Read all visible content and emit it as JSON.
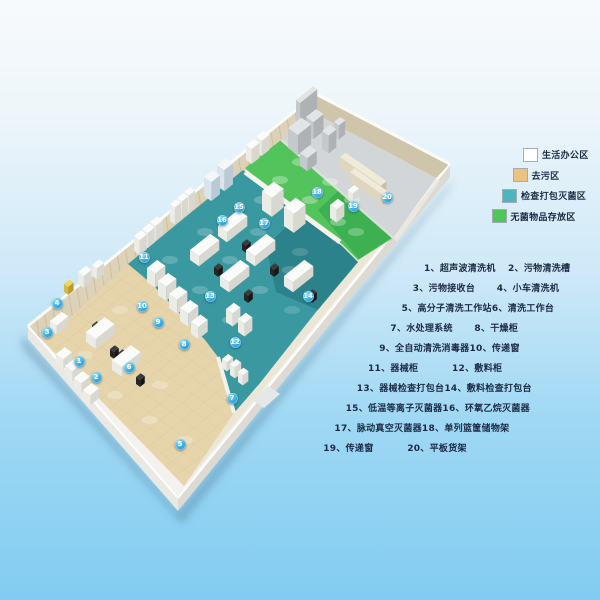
{
  "legend": {
    "items": [
      {
        "id": "office",
        "label": "生活办公区",
        "color": "#ffffff"
      },
      {
        "id": "decontamination",
        "label": "去污区",
        "color": "#e9c37f"
      },
      {
        "id": "inspect-pack-sterilize",
        "label": "检查打包灭菌区",
        "color": "#4db4c0"
      },
      {
        "id": "sterile-storage",
        "label": "无菌物品存放区",
        "color": "#4ec65c"
      }
    ]
  },
  "equipment_list": {
    "rows": [
      {
        "c1": "1、超声波清洗机",
        "c2": "2、污物清洗槽"
      },
      {
        "c1": "3、污物接收台",
        "c2": "4、小车清洗机"
      },
      {
        "c1": "5、高分子清洗工作站",
        "c2": "6、清洗工作台"
      },
      {
        "c1": "7、水处理系统",
        "c2": "8、干燥柜"
      },
      {
        "c1": "9、全自动清洗消毒器",
        "c2": "10、传递窗"
      },
      {
        "c1": "11、器械柜",
        "c2": "12、敷料柜"
      },
      {
        "c1": "13、器械检查打包台",
        "c2": "14、敷料检查打包台"
      },
      {
        "c1": "15、低温等离子灭菌器",
        "c2": "16、环氧乙烷灭菌器"
      },
      {
        "c1": "17、脉动真空灭菌器",
        "c2": "18、单列篮筐储物架"
      },
      {
        "c1": "19、传递窗",
        "c2": "20、平板货架"
      }
    ]
  },
  "floor_markers": [
    {
      "n": "1",
      "x": 79,
      "y": 361
    },
    {
      "n": "2",
      "x": 96,
      "y": 377
    },
    {
      "n": "3",
      "x": 47,
      "y": 332
    },
    {
      "n": "4",
      "x": 57,
      "y": 303
    },
    {
      "n": "5",
      "x": 180,
      "y": 444
    },
    {
      "n": "6",
      "x": 129,
      "y": 367
    },
    {
      "n": "7",
      "x": 232,
      "y": 398
    },
    {
      "n": "8",
      "x": 184,
      "y": 344
    },
    {
      "n": "9",
      "x": 158,
      "y": 322
    },
    {
      "n": "10",
      "x": 142,
      "y": 306
    },
    {
      "n": "11",
      "x": 144,
      "y": 257
    },
    {
      "n": "12",
      "x": 235,
      "y": 342
    },
    {
      "n": "13",
      "x": 210,
      "y": 296
    },
    {
      "n": "14",
      "x": 308,
      "y": 296
    },
    {
      "n": "15",
      "x": 239,
      "y": 207
    },
    {
      "n": "16",
      "x": 222,
      "y": 220
    },
    {
      "n": "17",
      "x": 264,
      "y": 223
    },
    {
      "n": "18",
      "x": 317,
      "y": 192
    },
    {
      "n": "19",
      "x": 353,
      "y": 206
    },
    {
      "n": "20",
      "x": 387,
      "y": 197
    }
  ],
  "palette": {
    "background_top": "#f7fafc",
    "background_bottom": "#82ccf1",
    "floor_decontamination": "#e6d5ab",
    "floor_sterilization": "#3a98a1",
    "floor_sterile_storage": "#53c35c",
    "floor_office": "#d3d6d8",
    "wall_upper_left": "#ddd2b7",
    "wall_upper_right": "#cfc5ab",
    "slab": "#f3f2ee",
    "marker_blue": "#2aa4dd",
    "text": "#1c2b45"
  }
}
